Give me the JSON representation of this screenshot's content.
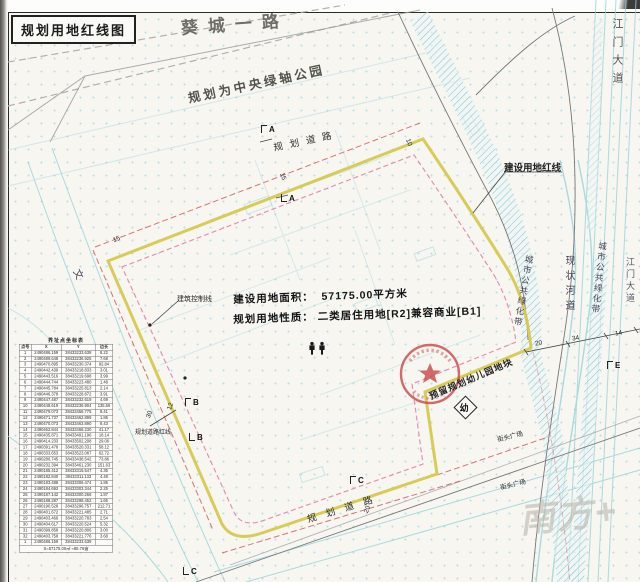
{
  "title": "规划用地红线图",
  "roads": {
    "kuicheng": "葵城一路",
    "jiangmen_top": "江门大道",
    "jiangmen_right": "江门大道",
    "planned_top": "规划道路",
    "planned_bottom": "规划道路",
    "left_road_char": "文"
  },
  "labels": {
    "park": "规划为中央绿轴公园",
    "construction_redline": "建设用地红线",
    "building_control_line": "建筑控制线",
    "road_redline": "规划道路红线",
    "greenbelt_left": "城市公共绿化带",
    "greenbelt_right": "城市公共绿化带",
    "river": "现状河道",
    "kindergarten": "预留规划幼儿园地块",
    "kindergarten_mark": "幼",
    "plaza_1": "街头广场",
    "plaza_2": "街头广场",
    "area_label": "建设用地面积：",
    "area_value": "57175.00平方米",
    "nature_label": "规划用地性质：",
    "nature_value": "二类居住用地[R2]兼容商业[B1]",
    "watermark": "南方+"
  },
  "annotations": {
    "dims": [
      {
        "t": "15",
        "x": 279,
        "y": 173,
        "r": 70
      },
      {
        "t": "10",
        "x": 405,
        "y": 139,
        "r": 70
      },
      {
        "t": "15",
        "x": 113,
        "y": 236,
        "r": -20
      },
      {
        "t": "30",
        "x": 146,
        "y": 411,
        "r": -70
      },
      {
        "t": "12",
        "x": 167,
        "y": 403,
        "r": -70
      },
      {
        "t": "20",
        "x": 364,
        "y": 506,
        "r": -70
      },
      {
        "t": "20",
        "x": 535,
        "y": 340,
        "r": -10
      },
      {
        "t": "34",
        "x": 572,
        "y": 335,
        "r": -10
      },
      {
        "t": "14",
        "x": 615,
        "y": 330,
        "r": -10
      }
    ],
    "markers": [
      {
        "t": "A",
        "x": 261,
        "y": 125,
        "br": "tl"
      },
      {
        "t": "A",
        "x": 281,
        "y": 194,
        "br": "bl"
      },
      {
        "t": "B",
        "x": 185,
        "y": 398,
        "br": "tl"
      },
      {
        "t": "B",
        "x": 189,
        "y": 433,
        "br": "bl"
      },
      {
        "t": "C",
        "x": 350,
        "y": 476,
        "br": "tl"
      },
      {
        "t": "C",
        "x": 183,
        "y": 567,
        "br": "bl"
      },
      {
        "t": "E",
        "x": 607,
        "y": 361,
        "br": "tl"
      }
    ]
  },
  "table": {
    "title": "界址点坐标表",
    "headers": [
      "点号",
      "X",
      "Y",
      "边长"
    ],
    "rows": [
      [
        "1",
        "2490486.159",
        "38433233.638",
        "8.22"
      ],
      [
        "2",
        "2490489.648",
        "38433236.925",
        "7.68"
      ],
      [
        "3",
        "2490470.895",
        "38433230.374",
        "92.84"
      ],
      [
        "4",
        "2490442.439",
        "38433218.833",
        "3.01"
      ],
      [
        "5",
        "2490443.516",
        "38433219.698",
        "3.99"
      ],
      [
        "6",
        "2490444.744",
        "38433223.480",
        "1.48"
      ],
      [
        "7",
        "2490445.784",
        "38433225.813",
        "2.14"
      ],
      [
        "8",
        "2490446.378",
        "38433228.872",
        "3.91"
      ],
      [
        "9",
        "2490447.487",
        "38433232.619",
        "4.69"
      ],
      [
        "10",
        "2490448.619",
        "38433236.904",
        "135.56"
      ],
      [
        "11",
        "2490479.073",
        "38433456.775",
        "8.41"
      ],
      [
        "12",
        "2490471.737",
        "38433462.899",
        "1.85"
      ],
      [
        "13",
        "2490470.073",
        "38433463.890",
        "8.43"
      ],
      [
        "14",
        "2490462.844",
        "38433468.230",
        "41.17"
      ],
      [
        "15",
        "2490435.871",
        "38433491.196",
        "18.14"
      ],
      [
        "16",
        "2490414.233",
        "38433502.208",
        "29.06"
      ],
      [
        "17",
        "2490391.478",
        "38433520.331",
        "58.12"
      ],
      [
        "18",
        "2490333.653",
        "38433523.087",
        "62.72"
      ],
      [
        "19",
        "2490280.745",
        "38433438.542",
        "73.86"
      ],
      [
        "20",
        "2490232.394",
        "38433461.230",
        "151.63"
      ],
      [
        "21",
        "2490185.412",
        "38433315.547",
        "4.35"
      ],
      [
        "22",
        "2490182.840",
        "38433311.133",
        "4.48"
      ],
      [
        "23",
        "2490183.488",
        "38433306.474",
        "1.85"
      ],
      [
        "24",
        "2490184.693",
        "38433303.344",
        "2.25"
      ],
      [
        "25",
        "2490187.142",
        "38433300.266",
        "1.87"
      ],
      [
        "26",
        "2490188.287",
        "38433298.452",
        "1.65"
      ],
      [
        "27",
        "2490190.528",
        "38433296.757",
        "212.71"
      ],
      [
        "28",
        "2490401.672",
        "38433221.485",
        "2.71"
      ],
      [
        "29",
        "2490403.466",
        "38433220.783",
        "2.54"
      ],
      [
        "30",
        "2490404.617",
        "38433220.524",
        "5.32"
      ],
      [
        "31",
        "2490399.858",
        "38433220.806",
        "3.00"
      ],
      [
        "32",
        "2490403.758",
        "38433221.776",
        "3.68"
      ],
      [
        "1",
        "2490486.159",
        "38433233.638",
        ""
      ]
    ],
    "summary": "S=57175.00㎡ ≈85.76亩"
  },
  "colors": {
    "boundary_yellow": "#d6c94e",
    "control_magenta": "#e07fa0",
    "road_red": "#cc5555",
    "cadastral_cyan": "#97d2da",
    "stamp_red": "#c84848"
  }
}
